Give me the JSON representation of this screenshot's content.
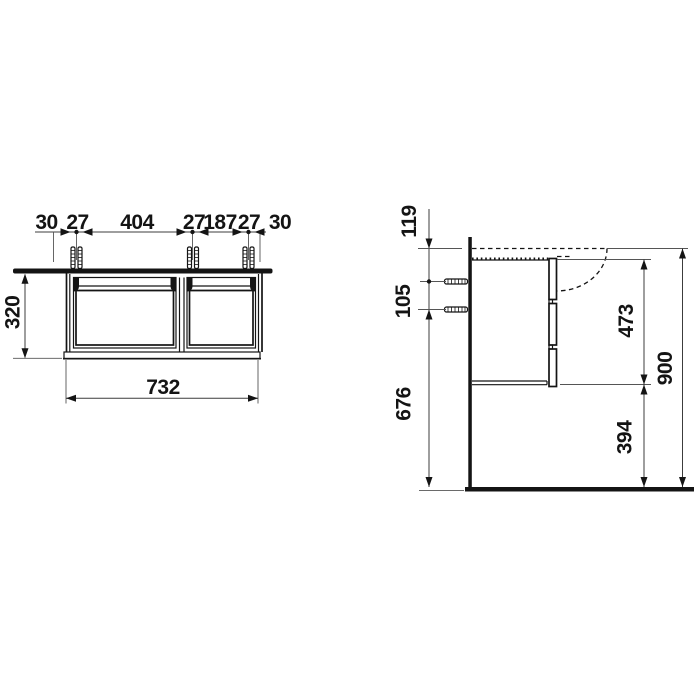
{
  "drawing": {
    "front_view": {
      "chain": [
        "30",
        "27",
        "404",
        "27",
        "187",
        "27",
        "30"
      ],
      "cabinet_height": "320",
      "cabinet_width": "732"
    },
    "side_view": {
      "rim_to_top_hole": "119",
      "hole_spacing": "105",
      "lower_hole_to_floor": "676",
      "body_height": "473",
      "bottom_clearance": "394",
      "overall_height": "900"
    },
    "colors": {
      "object_line": "#141414",
      "dimension_line": "#3c3c3c",
      "background": "#ffffff"
    }
  }
}
